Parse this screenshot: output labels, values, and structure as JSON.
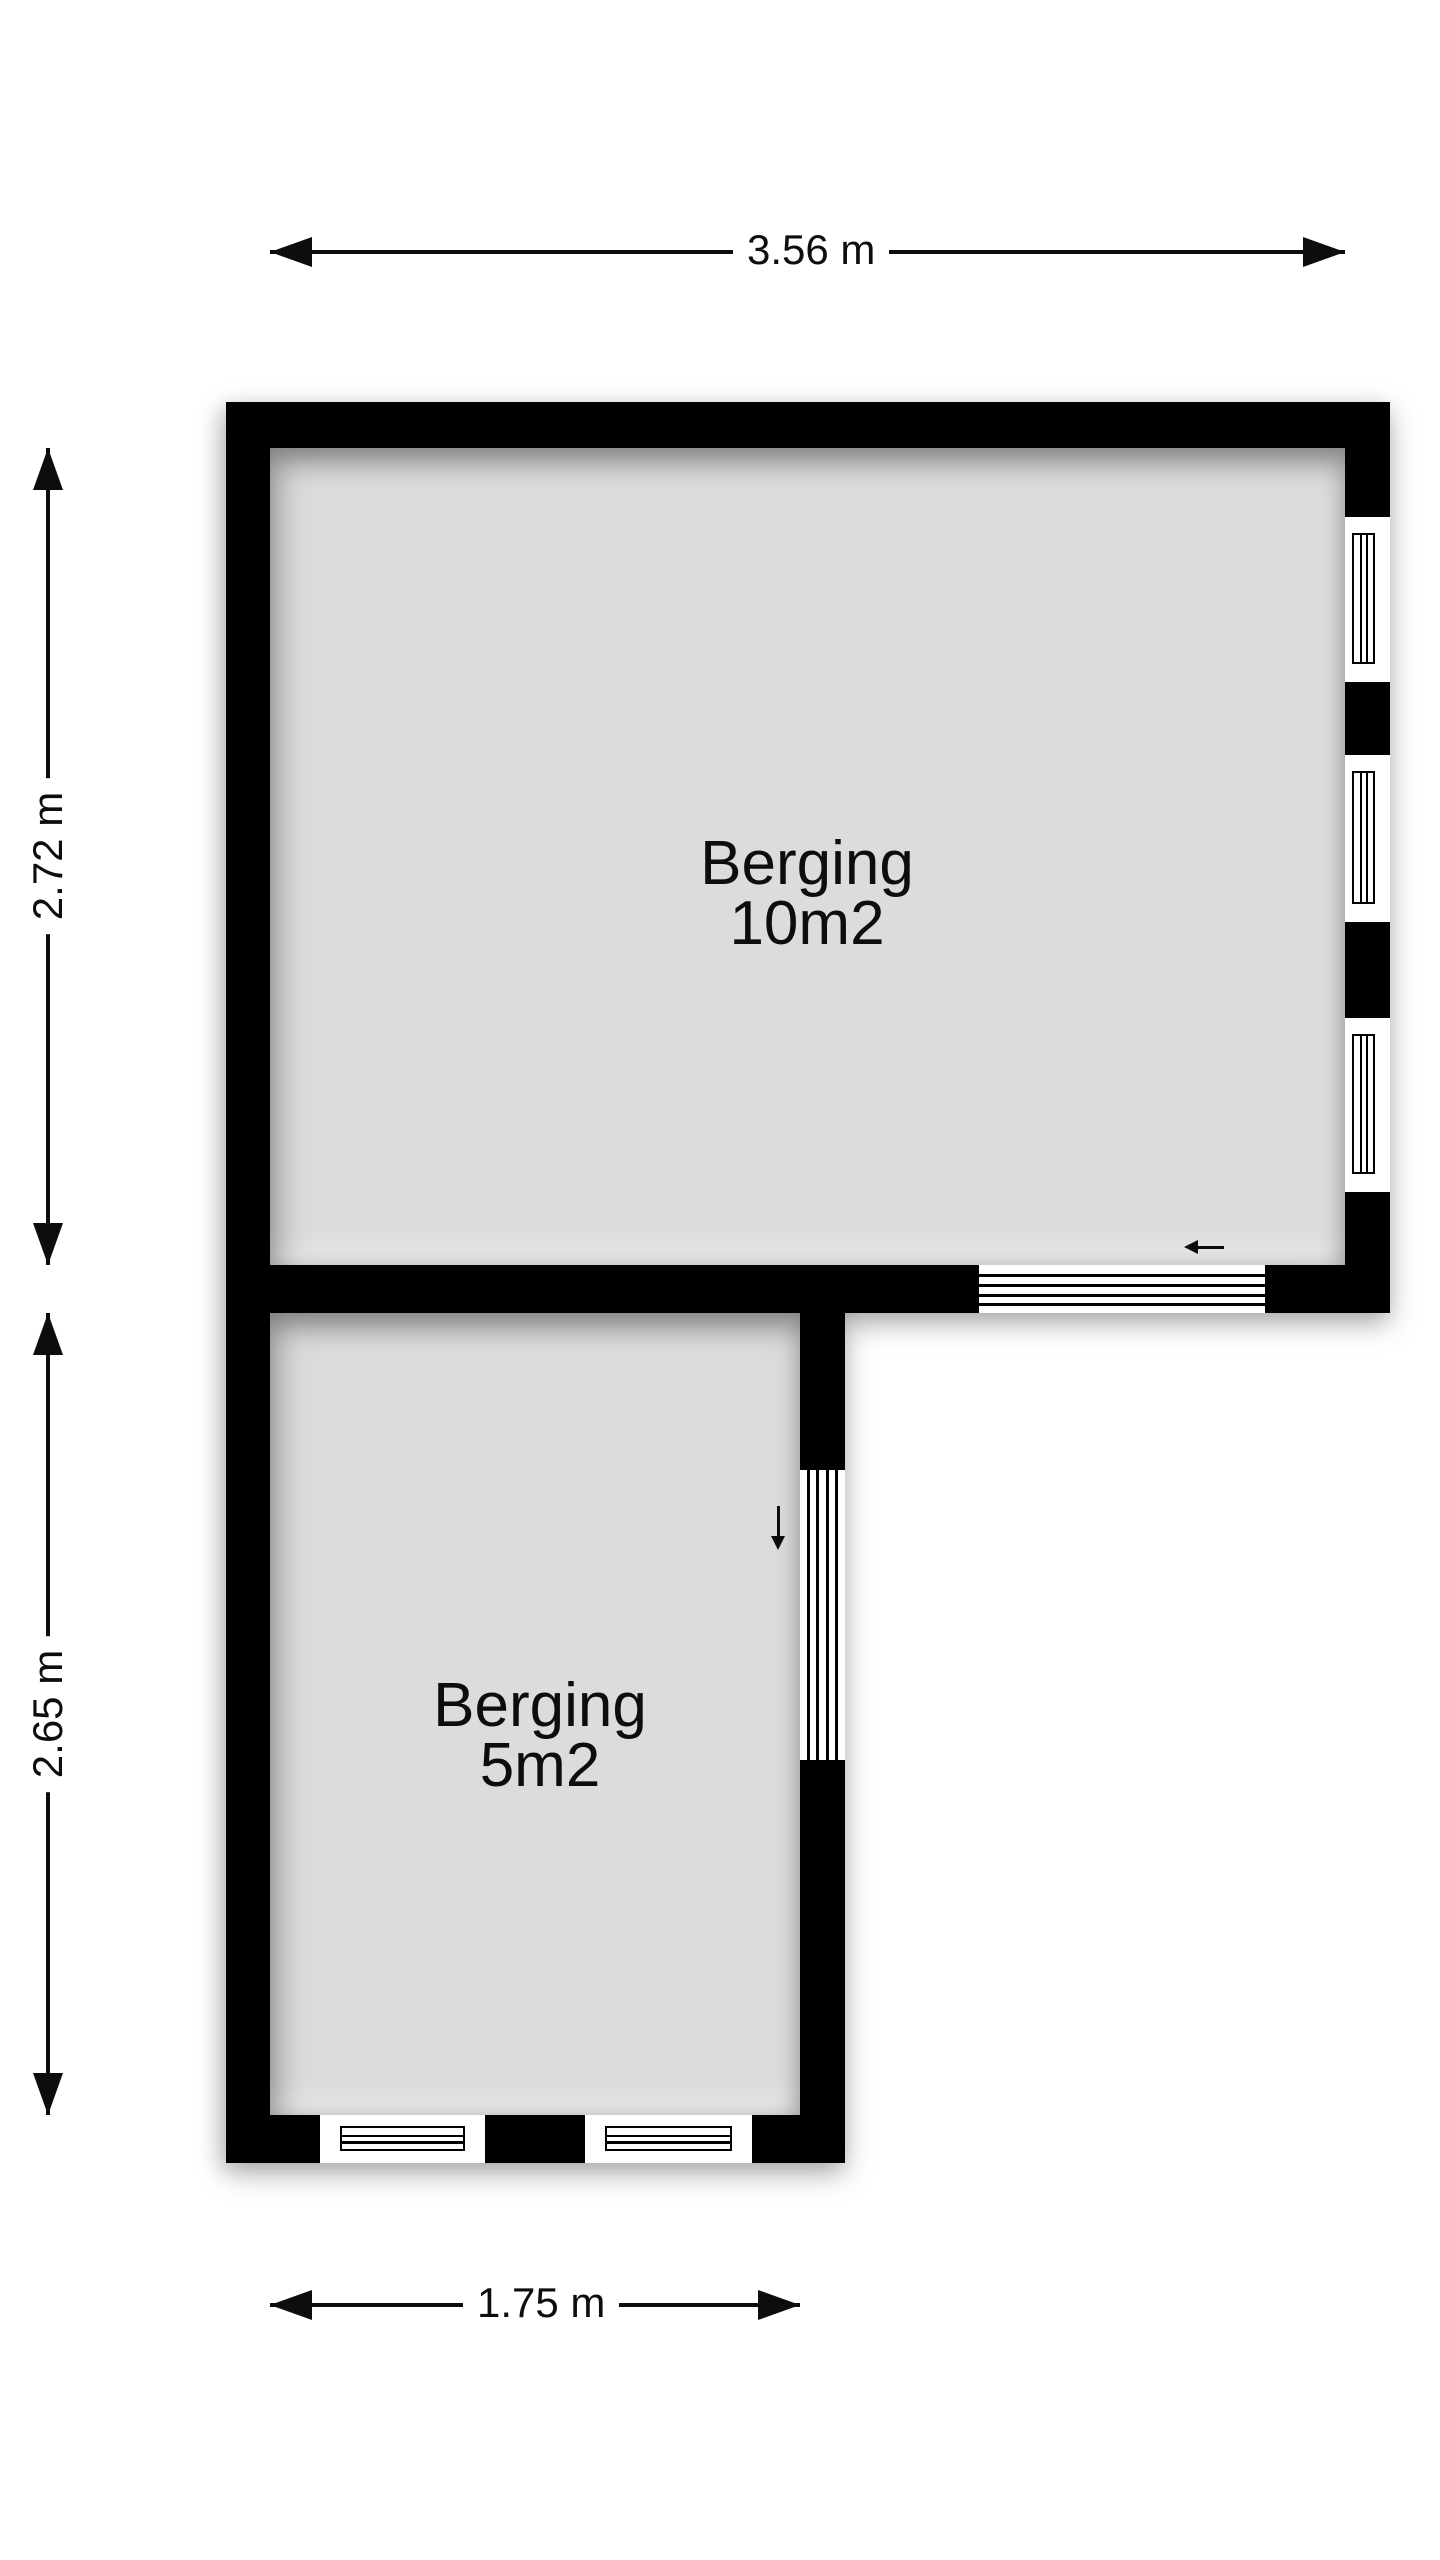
{
  "floorplan": {
    "rooms": [
      {
        "label": "Berging",
        "area_label": "10m2"
      },
      {
        "label": "Berging",
        "area_label": "5m2"
      }
    ],
    "dimensions": {
      "top": "3.56 m",
      "left_upper": "2.72 m",
      "left_lower": "2.65 m",
      "bottom": "1.75 m"
    },
    "icons": {
      "door_swing_upper": "left-arrow-icon",
      "door_swing_lower": "down-arrow-icon"
    },
    "colors": {
      "wall": "#000000",
      "room_fill": "#dcdcdc",
      "background": "#ffffff",
      "text": "#0d0d0d"
    }
  }
}
